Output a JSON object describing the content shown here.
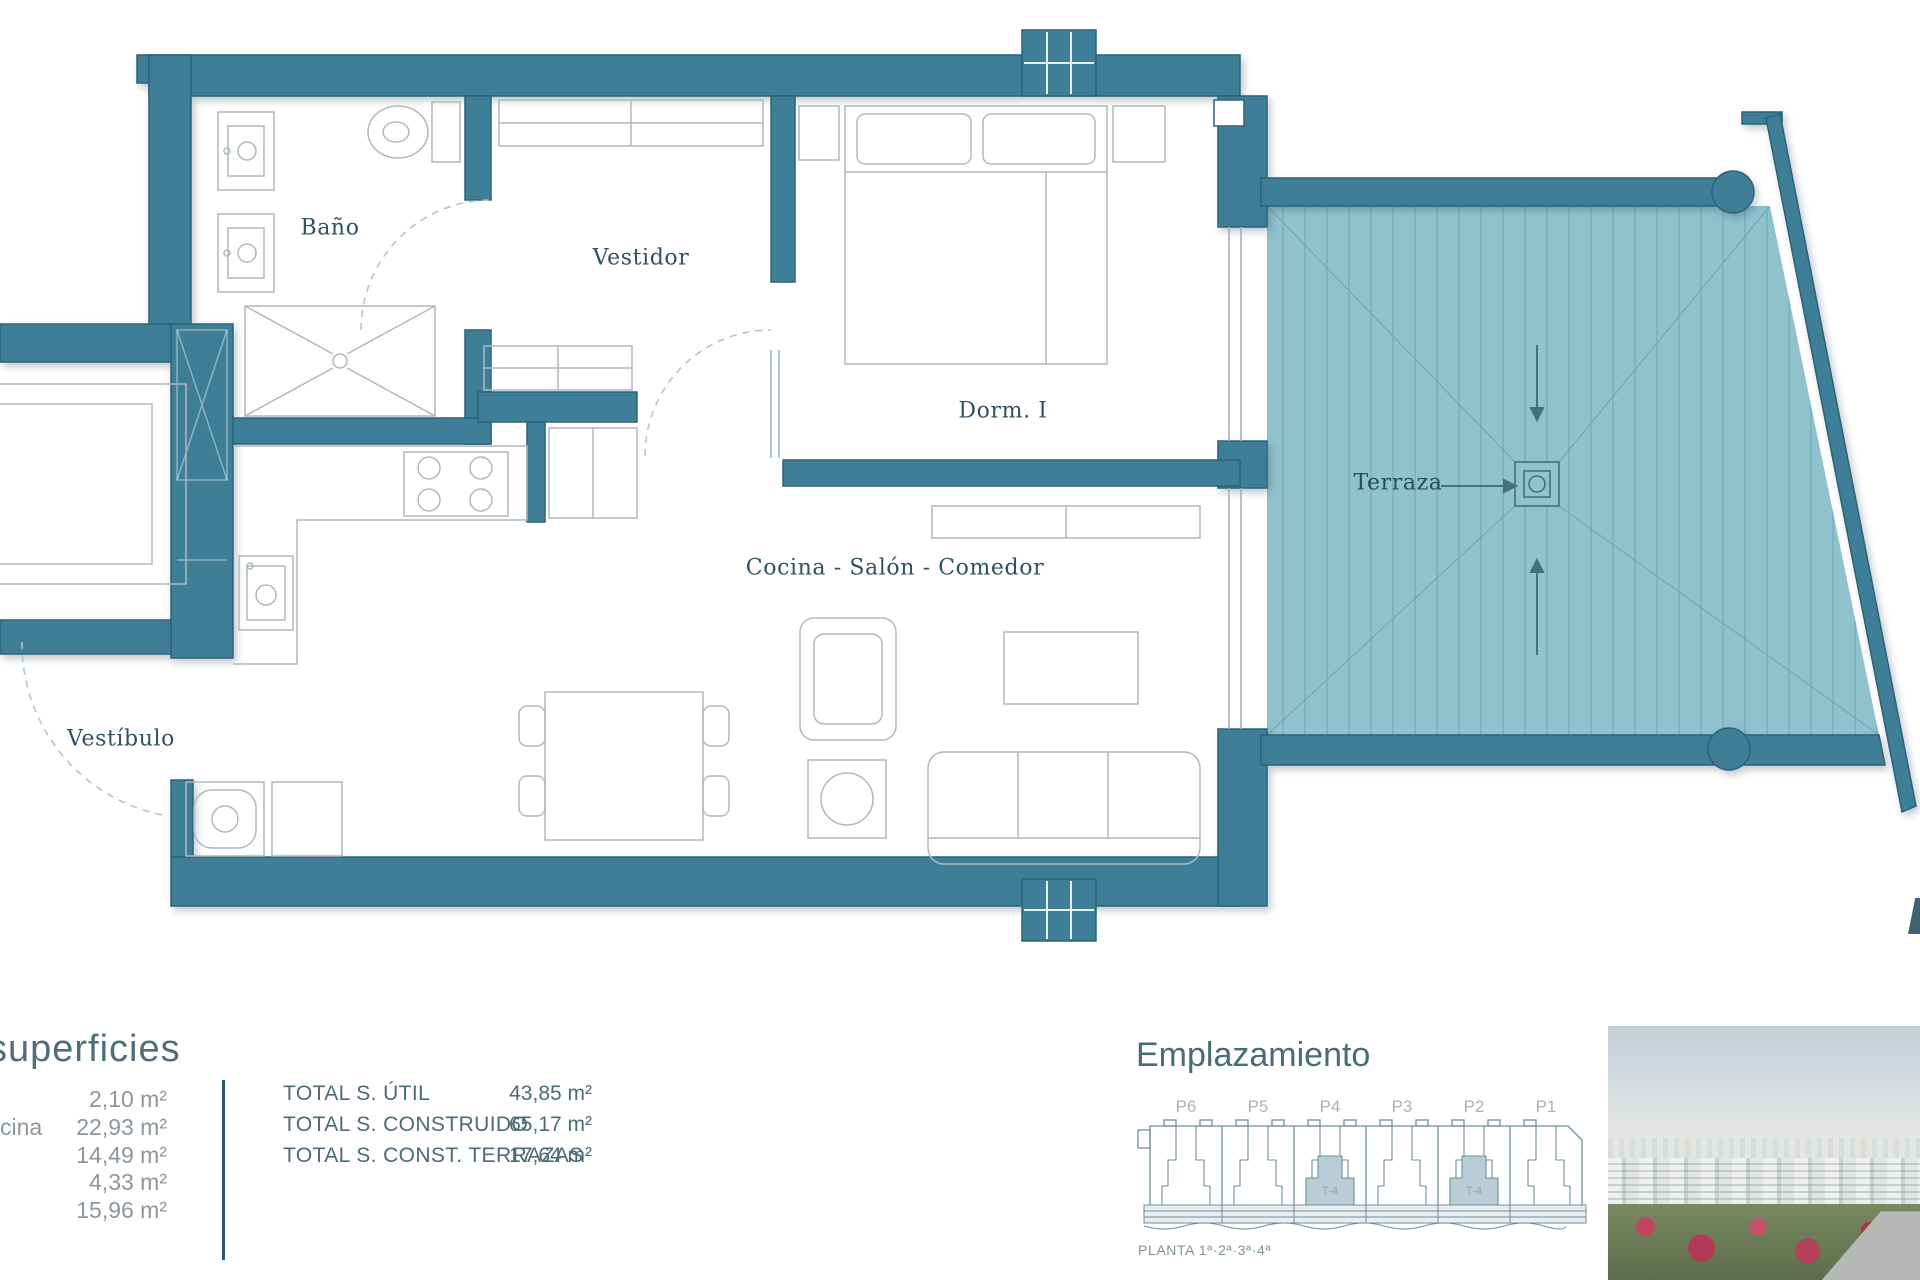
{
  "colors": {
    "wall": "#3E7E97",
    "terrace": "#8FC2CD",
    "text_accent": "#4E6F7A"
  },
  "plan": {
    "rooms": {
      "bano": "Baño",
      "vestidor": "Vestidor",
      "dorm1": "Dorm. I",
      "terraza": "Terraza",
      "cocina_salon_comedor": "Cocina - Salón - Comedor",
      "vestibulo": "Vestíbulo"
    }
  },
  "superficies": {
    "title": "superficies",
    "row_label_fragment": "cina",
    "rows": [
      {
        "value": "2,10 m²"
      },
      {
        "value": "22,93 m²"
      },
      {
        "value": "14,49 m²"
      },
      {
        "value": "4,33 m²"
      },
      {
        "value": "15,96 m²"
      }
    ],
    "totals": [
      {
        "label": "TOTAL S. ÚTIL",
        "value": "43,85 m²"
      },
      {
        "label": "TOTAL S. CONSTRUIDO",
        "value": "65,17 m²"
      },
      {
        "label": "TOTAL S. CONST. TERRAZAS",
        "value": "17,64 m²"
      }
    ]
  },
  "emplazamiento": {
    "title": "Emplazamiento",
    "portals": [
      "P6",
      "P5",
      "P4",
      "P3",
      "P2",
      "P1"
    ],
    "highlighted_unit": "T-4",
    "caption": "PLANTA 1ª·2ª·3ª·4ª"
  }
}
